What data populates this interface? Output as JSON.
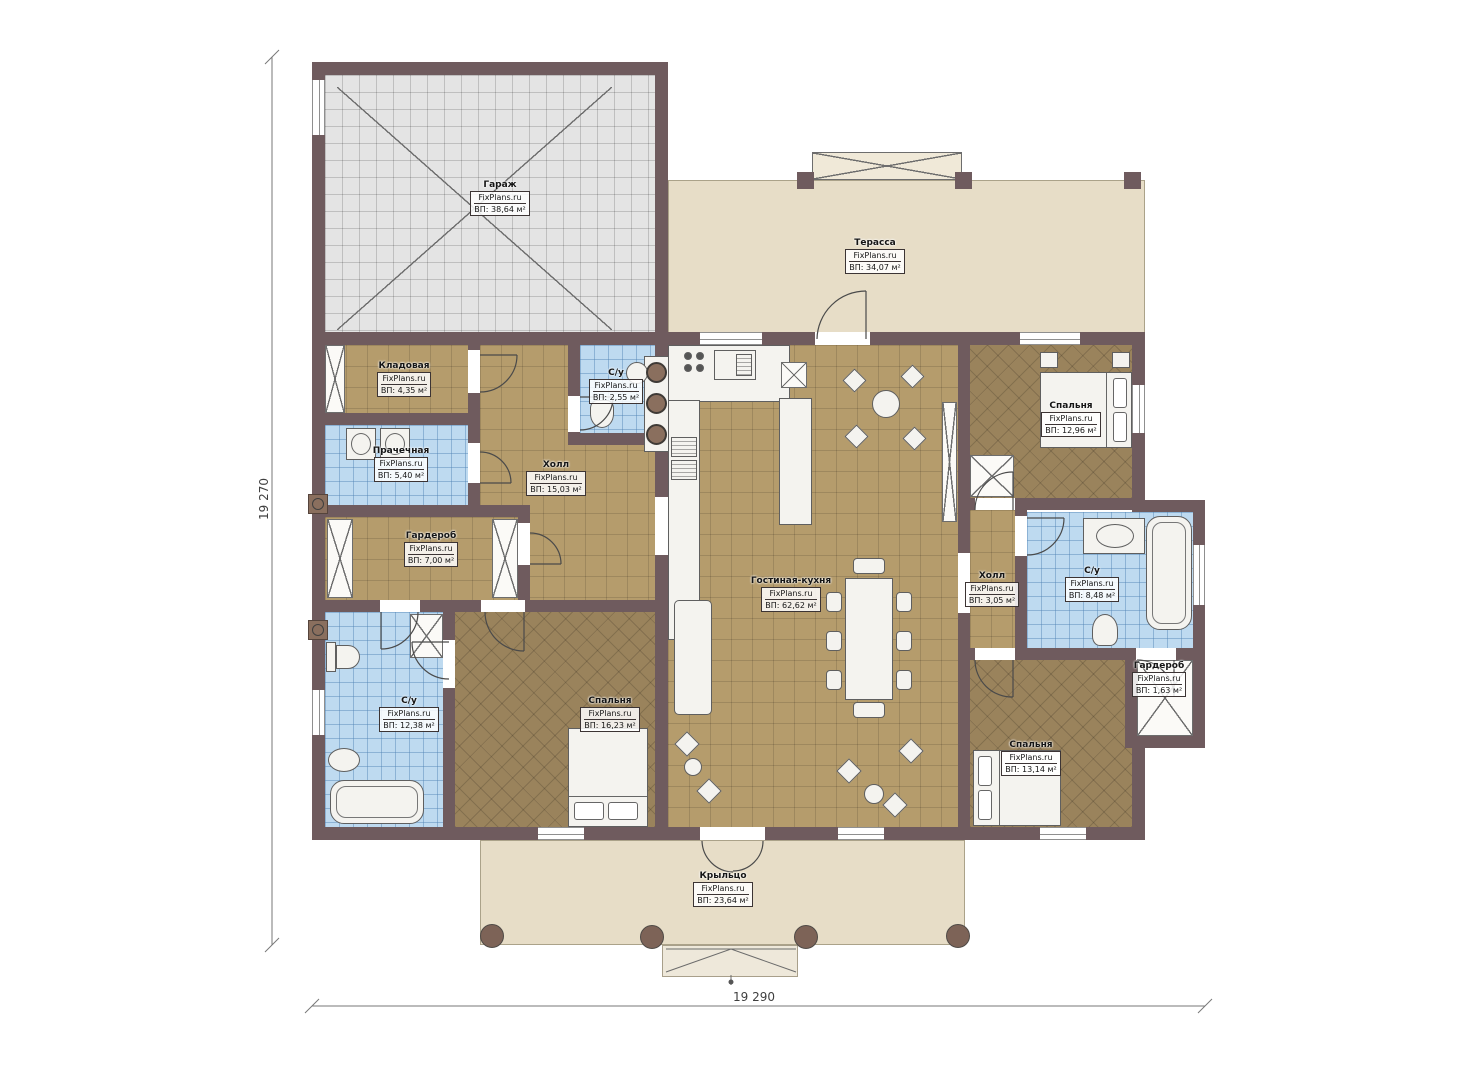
{
  "plan": {
    "brand": "FixPlans.ru",
    "dimensions": {
      "left": "19 270",
      "bottom": "19 290"
    },
    "colors": {
      "wall": "#6f5b5e",
      "floor_tan": "#b59c6c",
      "floor_bedroom": "#9a835c",
      "tile_blue": "#bedaf0",
      "garage_gray": "#e4e4e4",
      "outdoor_beige": "#e7ddc7"
    },
    "rooms": [
      {
        "name": "Гараж",
        "brand": "FixPlans.ru",
        "area": "ВП: 38,64 м²"
      },
      {
        "name": "Терасса",
        "brand": "FixPlans.ru",
        "area": "ВП: 34,07 м²"
      },
      {
        "name": "Кладовая",
        "brand": "FixPlans.ru",
        "area": "ВП: 4,35 м²"
      },
      {
        "name": "С/у",
        "brand": "FixPlans.ru",
        "area": "ВП: 2,55 м²"
      },
      {
        "name": "Прачечная",
        "brand": "FixPlans.ru",
        "area": "ВП: 5,40 м²"
      },
      {
        "name": "Холл",
        "brand": "FixPlans.ru",
        "area": "ВП: 15,03 м²"
      },
      {
        "name": "Гардероб",
        "brand": "FixPlans.ru",
        "area": "ВП: 7,00 м²"
      },
      {
        "name": "Спальня",
        "brand": "FixPlans.ru",
        "area": "ВП: 12,96 м²"
      },
      {
        "name": "Гостиная-кухня",
        "brand": "FixPlans.ru",
        "area": "ВП: 62,62 м²"
      },
      {
        "name": "Холл",
        "brand": "FixPlans.ru",
        "area": "ВП: 3,05 м²"
      },
      {
        "name": "С/у",
        "brand": "FixPlans.ru",
        "area": "ВП: 8,48 м²"
      },
      {
        "name": "Гардероб",
        "brand": "FixPlans.ru",
        "area": "ВП: 1,63 м²"
      },
      {
        "name": "С/у",
        "brand": "FixPlans.ru",
        "area": "ВП: 12,38 м²"
      },
      {
        "name": "Спальня",
        "brand": "FixPlans.ru",
        "area": "ВП: 16,23 м²"
      },
      {
        "name": "Спальня",
        "brand": "FixPlans.ru",
        "area": "ВП: 13,14 м²"
      },
      {
        "name": "Крыльцо",
        "brand": "FixPlans.ru",
        "area": "ВП: 23,64 м²"
      }
    ]
  }
}
